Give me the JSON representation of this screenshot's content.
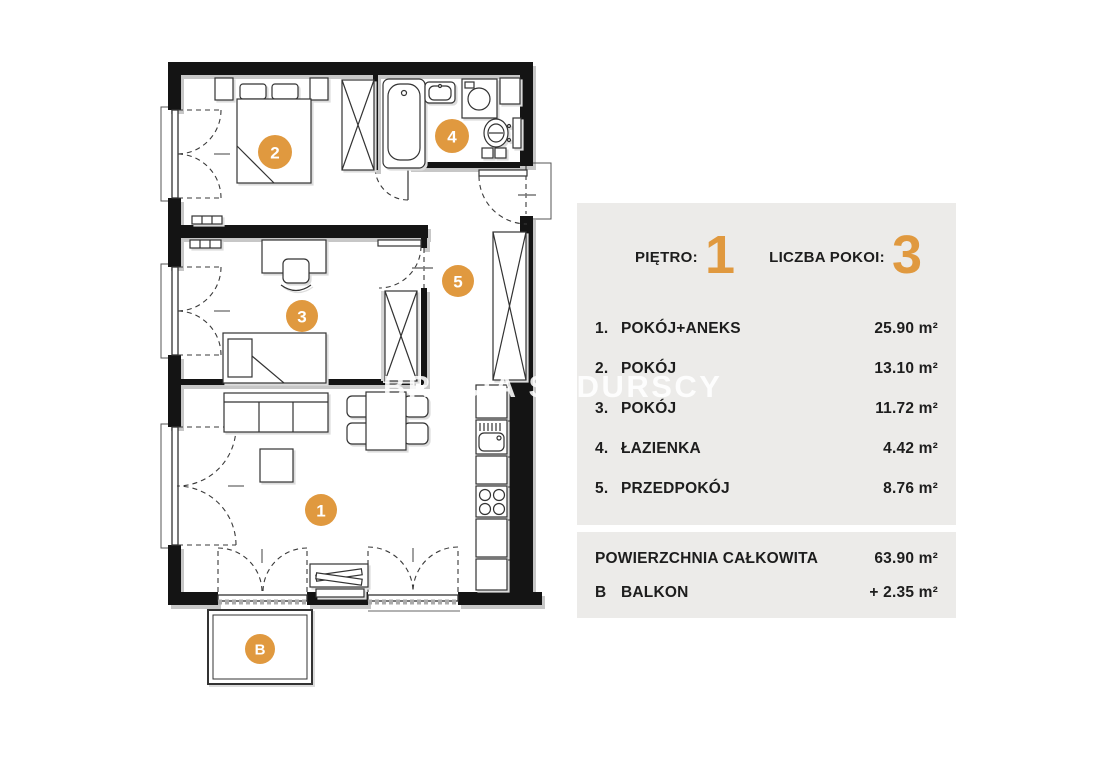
{
  "watermark": "BRACIA SADURSCY",
  "info_panel": {
    "floor_label": "PIĘTRO:",
    "floor_value": "1",
    "rooms_count_label": "LICZBA POKOI:",
    "rooms_count_value": "3",
    "rooms": [
      {
        "num": "1.",
        "name": "POKÓJ+ANEKS",
        "area": "25.90 m²"
      },
      {
        "num": "2.",
        "name": "POKÓJ",
        "area": "13.10 m²"
      },
      {
        "num": "3.",
        "name": "POKÓJ",
        "area": "11.72 m²"
      },
      {
        "num": "4.",
        "name": "ŁAZIENKA",
        "area": "4.42 m²"
      },
      {
        "num": "5.",
        "name": "PRZEDPOKÓJ",
        "area": "8.76 m²"
      }
    ],
    "total_label": "POWIERZCHNIA CAŁKOWITA",
    "total_area": "63.90 m²",
    "balcony_key": "B",
    "balcony_label": "BALKON",
    "balcony_area": "+ 2.35 m²"
  },
  "plan": {
    "accent_color": "#E0993F",
    "markers": {
      "room1": "1",
      "room2": "2",
      "room3": "3",
      "room4": "4",
      "room5": "5",
      "balcony": "B"
    }
  }
}
